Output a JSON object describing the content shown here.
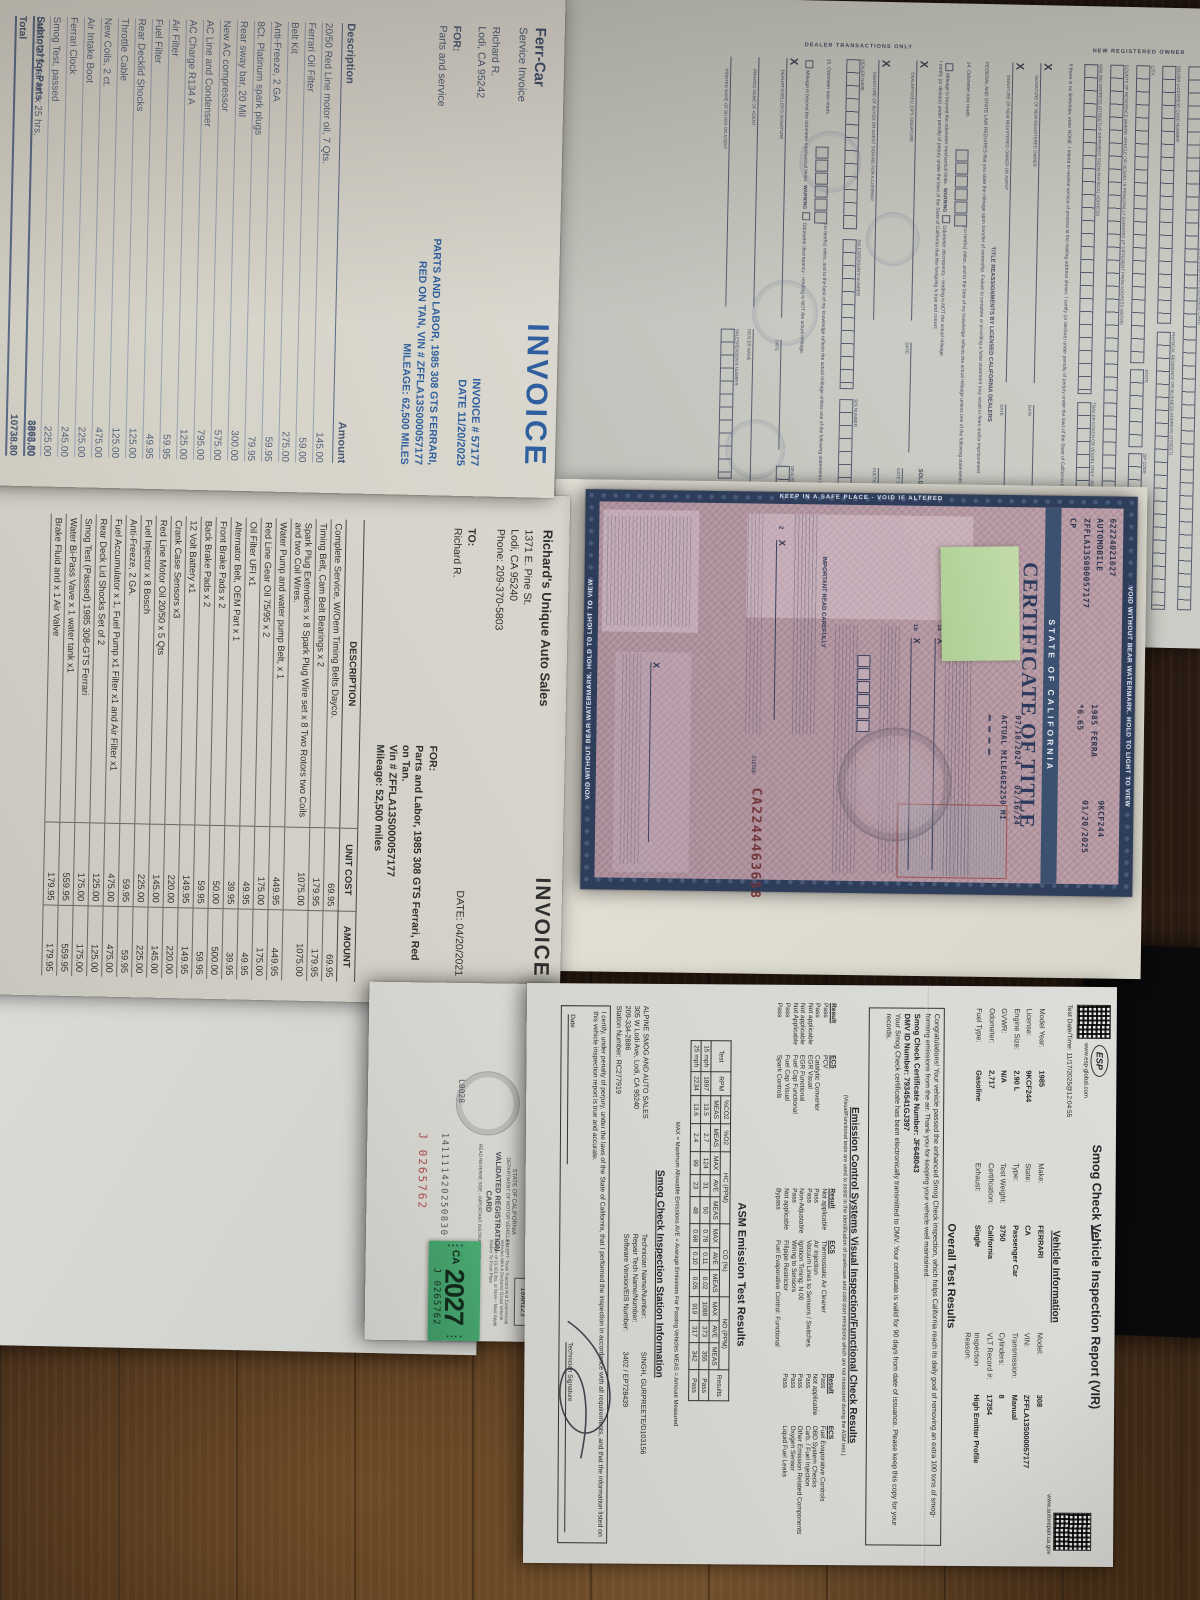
{
  "invoice1": {
    "company": "Ferr-Car",
    "subtitle": "Service Invoice",
    "customer_name": "Richard R.",
    "customer_city": "Lodi, CA 95242",
    "for_label": "FOR:",
    "for_value": "Parts and service",
    "title": "INVOICE",
    "invoice_no": "INVOICE # 57177",
    "date": "DATE 11/20/2025",
    "vehicle_line1": "PARTS AND LABOR, 1985 308 GTS FERRARI,",
    "vehicle_line2": "RED ON TAN, VIN # ZFFLA13S000057177",
    "vehicle_line3": "MILEAGE: 62,500 MILES",
    "col_desc": "Description",
    "col_amount": "Amount",
    "items": [
      {
        "d": "20/50 Red Line motor oil, 7 Qts.",
        "a": "145.00"
      },
      {
        "d": "Ferrari Oil Filter",
        "a": "59.00"
      },
      {
        "d": "Belt Kit",
        "a": "275.00"
      },
      {
        "d": "Anti-Freeze, 2 GA",
        "a": "59.95"
      },
      {
        "d": "8Ct. Platinum spark plugs",
        "a": "79.95"
      },
      {
        "d": "Rear sway bar, 20 Mil",
        "a": "300.00"
      },
      {
        "d": "New AC compressor",
        "a": "575.00"
      },
      {
        "d": "AC Line and Condenser",
        "a": "795.00"
      },
      {
        "d": "AC Charge R134 A",
        "a": "125.00"
      },
      {
        "d": "Air Filter",
        "a": "59.95"
      },
      {
        "d": "Fuel Filter",
        "a": "49.95"
      },
      {
        "d": "Rear Decklid Shocks",
        "a": "125.00"
      },
      {
        "d": "Throttle Cable",
        "a": "125.00"
      },
      {
        "d": "New Coils, 2 ct.",
        "a": "475.00"
      },
      {
        "d": "Air Intake Boot",
        "a": "225.00"
      },
      {
        "d": "Ferrari Clock",
        "a": "245.00"
      },
      {
        "d": "Smog Test, passed",
        "a": "225.00"
      },
      {
        "d": "Labor, 275 per hr. x 25 hrs.",
        "a": "6875.00"
      }
    ],
    "subtotal_label": "Subtotal for Parts",
    "subtotal": "3863.80",
    "total_label": "Total",
    "total": "10738.80"
  },
  "dmv_form": {
    "headline": "Any change of registered owner or lienholder must be recorded with the Department of Motor Vehicles (DMV) within ten (10) days. This transfer form, the title, and all smog and use-tax certificates must be presented to DMV to record the ownership change.",
    "section_owner": "NEW REGISTERED OWNER",
    "section_dealer": "DEALER TRANSACTIONS ONLY",
    "r1": "1a. TRUE FULL NAME OF NEW REGISTERED OWNER (LAST, FIRST, MIDDLE) AS IT APPEARS ON DRIVER LICENSE/ID CARD",
    "r2": "DRIVER LICENSE/ID CARD NUMBER",
    "r3": "PHYSICAL RESIDENCE OR BUSINESS ADDRESS (STREET)",
    "r4": "CITY",
    "r5": "STATE",
    "r6": "ZIP CODE",
    "r7": "COUNTY OF RESIDENCE WHERE VEHICLE OR VESSEL IS PRINCIPALLY GARAGED (IF DIFFERENT FROM ADDRESS ABOVE)",
    "r8": "MAILING ADDRESS (STREET) IF DIFFERENT FROM PHYSICAL ADDRESS",
    "r9": "TRAILER COACH OR VESSEL ONLY - ADDRESS WHERE LOCATED",
    "lien_text": "If there is no lienholder, enter NONE. I intend to receive service of process at the mailing address shown. I certify (or declare) under penalty of perjury under the laws of the State of California that the foregoing is true and correct.",
    "x": "X",
    "date_label": "DATE",
    "sig_owner": "SIGNATURE OF NEW REGISTERED OWNER",
    "sig_owner2": "SIGNATURE OF NEW REGISTERED OWNER OR AGENT",
    "reassign_title": "TITLE REASSIGNMENTS BY LICENSED CALIFORNIA DEALERS",
    "federal": "FEDERAL AND STATE LAW REQUIRES that you state the mileage upon transfer of ownership. Failure to complete or providing a false statement may result in fines and/or imprisonment.",
    "odo14": "14. Odometer now reads",
    "odo15": "15. Odometer now reads",
    "odo_tail": "(no tenths) miles, and to the best of my knowledge reflects the actual mileage unless one of the following statements is checked:",
    "warning": "WARNING",
    "opt1": "Mileage is beyond the odometer mechanical limits.",
    "opt2": "Odometer discrepancy - reading is NOT the actual mileage.",
    "certify": "I certify (or declare) under penalty of perjury under the laws of the State of California that the foregoing is true and correct.",
    "seller_sig": "DEALER'S/SELLER'S SIGNATURE",
    "buyer_sig": "SIGNATURE OF BUYER OR AGENT SIGNING FOR A COMPANY",
    "auction_title": "SOLD THROUGH AUCTION IF APPLICABLE",
    "auction_date": "DATE OF AUCTION",
    "auction_name": "AUCTION NAME",
    "printed_agent": "PRINTED NAME OF AGENT",
    "printed_buyer": "PRINTED NAME OF BUYER OR AGENT",
    "dealer_name": "DEALER NAME",
    "sales_no": "SALESPERSON'S NUMBER",
    "rs_no": "R/S NUMBER",
    "dealer_no": "DEALER NUMBER",
    "elt": "ELT #"
  },
  "title_doc": {
    "border_top": "VOID WITHOUT BEAR WATERMARK. HOLD TO LIGHT TO VIEW",
    "border_bottom": "VOID WITHOUT BEAR WATERMARK. HOLD TO LIGHT TO VIEW",
    "border_left": "KEEP IN A SAFE PLACE - VOID IF ALTERED",
    "state": "STATE OF CALIFORNIA",
    "title": "CERTIFICATE OF TITLE",
    "doc_no": "62224021627",
    "body_type": "AUTOMOBILE",
    "vin": "ZFFLA13S000057177",
    "code": "CP",
    "yr_make": "1985 FERRA",
    "fee": "*6.65",
    "license": "9KCF244",
    "expires": "01/20/2025",
    "issued": "07/18/2024",
    "odo_date": "02/16/24",
    "odometer": "2250 MI",
    "mileage_label": "ACTUAL MILEAGE",
    "important": "IMPORTANT READ CAREFULLY",
    "sig1": "1a",
    "sig1b": "1b",
    "sig2": "2",
    "x": "X",
    "control_no": "CA2244463658",
    "form_no": "016586"
  },
  "invoice2": {
    "company": "Richard's Unique Auto Sales",
    "addr1": "1371 E. Pine St.",
    "addr2": "Lodi, CA 95240",
    "addr3": "Phone: 209-370-5803",
    "to_label": "TO:",
    "to_value": "Richard R.",
    "title": "INVOICE",
    "date": "DATE: 04/20/2021",
    "for_label": "FOR:",
    "for1": "Parts and Labor, 1985 308 GTS Ferrari, Red",
    "for2": "on Tan.",
    "for3": "Vin # ZFFLA13S000057177",
    "for4": "Mileage: 52,500 miles",
    "col_desc": "DESCRIPTION",
    "col_unit": "UNIT COST",
    "col_amount": "AMOUNT",
    "items": [
      {
        "d": "Complete Service, W/Oem Timing Belts Dayco.",
        "u": "69.95",
        "a": "69.95"
      },
      {
        "d": "Timing Belt, Cam Belt Bearings x 2",
        "u": "179.95",
        "a": "179.95"
      },
      {
        "d": "Spark Plug Extenders x 8 Spark Plug Wire set x 8 Two Rotors two Coils and two Coil Wires.",
        "u": "1075.00",
        "a": "1075.00"
      },
      {
        "d": "Water Pump and water pump Belt, x 1",
        "u": "449.95",
        "a": "449.95"
      },
      {
        "d": "Red Line Gear Oil 75/95 x 2",
        "u": "175.00",
        "a": "175.00"
      },
      {
        "d": "Oil Filter UFI x1",
        "u": "49.95",
        "a": "49.95"
      },
      {
        "d": "Alternator Belt, OEM Part x 1",
        "u": "39.95",
        "a": "39.95"
      },
      {
        "d": "Front Brake Pads x 2",
        "u": "50.00",
        "a": "500.00"
      },
      {
        "d": "Back Brake Pads x 2",
        "u": "59.95",
        "a": "59.95"
      },
      {
        "d": "12 Volt Battery x1",
        "u": "149.95",
        "a": "149.95"
      },
      {
        "d": "Crank Case Sensors x3",
        "u": "220.00",
        "a": "220.00"
      },
      {
        "d": "Red Line Motor Oil 20/50 x 5 Qts",
        "u": "145.00",
        "a": "145.00"
      },
      {
        "d": "Fuel Injector x 8 Bosch",
        "u": "225.00",
        "a": "225.00"
      },
      {
        "d": "Anti-Freeze, 2 GA.",
        "u": "59.95",
        "a": "59.95"
      },
      {
        "d": "Fuel Accumulator x 1, Fuel Pump x1 Filter x1 and Air Filter x1",
        "u": "475.00",
        "a": "475.00"
      },
      {
        "d": "Rear Deck Lid Shocks Set of 2",
        "u": "125.00",
        "a": "125.00"
      },
      {
        "d": "Smog Test (Passed) 1985 308-GTS Ferrari",
        "u": "175.00",
        "a": "175.00"
      },
      {
        "d": "Water Bi-Pass Vave x 1 water tank x1",
        "u": "559.95",
        "a": "559.95"
      },
      {
        "d": "Brake Fluid and x 1 Air Valve",
        "u": "179.95",
        "a": "179.95"
      }
    ]
  },
  "reg_card": {
    "address_line": "LODI  CA  95242-8553",
    "state": "STATE OF CALIFORNIA",
    "dept": "DEPARTMENT OF MOTOR VEHICLES",
    "card_title": "VALIDATED REGISTRATION CARD",
    "note": "READ REVERSE SIDE - IMPORTANT INSTRUCTIONS",
    "number": "141111420250830",
    "code": "L0028",
    "serial": "J 0265762",
    "others_label": "All Others: In Top Right Corner",
    "plate": "18AM123",
    "except_text": "EXCEPT: Truck Tractors And Commercial Vehicles With A Declared Gross Vehicle Weight of 10,001 lbs. or More - Must Apply Sticker To Front Plate",
    "sticker_ca": "CA",
    "sticker_year": "2027",
    "sticker_serial": "J 0265762"
  },
  "smog": {
    "title": "Smog Check Vehicle Inspection Report (VIR)",
    "esp": "ESP",
    "esp_url": "www.esp-global.com",
    "test_dt": "Test Date/Time: 11/17/2025@12:04:55",
    "ca_url": "www.autorepair.ca.gov",
    "veh_header": "Vehicle Information",
    "veh_fields": [
      {
        "k": "Model Year:",
        "v": "1985"
      },
      {
        "k": "Make:",
        "v": "FERRARI"
      },
      {
        "k": "Model:",
        "v": "308"
      },
      {
        "k": "License:",
        "v": "9KCF244"
      },
      {
        "k": "State:",
        "v": "CA"
      },
      {
        "k": "VIN:",
        "v": "ZFFLA13S000057177"
      },
      {
        "k": "Engine Size:",
        "v": "2.90 L"
      },
      {
        "k": "Type:",
        "v": "Passenger Car"
      },
      {
        "k": "Transmission:",
        "v": "Manual"
      },
      {
        "k": "GVWR:",
        "v": "N/A"
      },
      {
        "k": "Test Weight:",
        "v": "3750"
      },
      {
        "k": "Cylinders:",
        "v": "8"
      },
      {
        "k": "Odometer:",
        "v": "2,717"
      },
      {
        "k": "Certification:",
        "v": "California"
      },
      {
        "k": "VLT Record #:",
        "v": "17354"
      },
      {
        "k": "Fuel Type:",
        "v": "Gasoline"
      },
      {
        "k": "Exhaust:",
        "v": "Single"
      },
      {
        "k": "Inspection Reason:",
        "v": "High Emitter Profile"
      }
    ],
    "overall_header": "Overall Test Results",
    "congrats": "Congratulations! Your vehicle passed the enhanced Smog Check inspection, which helps California reach its daily goal of removing an extra 100 tons of smog-forming emissions from the air. Thank you for keeping your vehicle well maintained.",
    "cert_no": "Smog Check Certificate Number: JF648043",
    "dmv_id": "DMV ID Number: 7934541GJ397",
    "note1": "Your Smog Check certificate has been electronically transmitted to DMV.",
    "note2": "Your certificate is valid for 90 days from date of issuance.",
    "note3": "Please keep this copy for your records.",
    "ecs_header": "Emission Control Systems Visual Inspection/Functional Check Results",
    "ecs_sub": "(Visual/Functional tests are used to assist in the identification of crankcase and cold start emissions which are not measured during the ASM test.)",
    "col_result": "Result",
    "col_ecs": "ECS",
    "ecs1": [
      {
        "r": "Pass",
        "e": "PCV"
      },
      {
        "r": "Pass",
        "e": "Catalytic Converter"
      },
      {
        "r": "Not applicable",
        "e": "EGR Visual"
      },
      {
        "r": "Not applicable",
        "e": "EGR Functional"
      },
      {
        "r": "Not Applicable",
        "e": "Fuel Cap Functional"
      },
      {
        "r": "Pass",
        "e": "Fuel Cap Visual"
      },
      {
        "r": "Pass",
        "e": "Spark Controls"
      }
    ],
    "ecs2": [
      {
        "r": "Not applicable",
        "e": "Thermostatic Air Cleaner"
      },
      {
        "r": "Pass",
        "e": "Air Injection"
      },
      {
        "r": "Pass",
        "e": "Vacuum Lines to Sensors / Switches"
      },
      {
        "r": "Non-Adjustable",
        "e": "Ignition Timing: N 00"
      },
      {
        "r": "Pass",
        "e": "Wiring to Sensors"
      },
      {
        "r": "Not applicable",
        "e": "Fillpipe Restrictor"
      },
      {
        "r": "Bypass",
        "e": "Fuel Evaporative Control: Functional"
      }
    ],
    "ecs3": [
      {
        "r": "Pass",
        "e": "Fuel Evaporative Controls"
      },
      {
        "r": "Not applicable",
        "e": "OBD System Checks"
      },
      {
        "r": "Pass",
        "e": "Carb. / Fuel Injection"
      },
      {
        "r": "Pass",
        "e": "Other Emission Related Components"
      },
      {
        "r": "Pass",
        "e": "Oxygen Sensor"
      },
      {
        "r": "Pass",
        "e": "Liquid Fuel Leaks"
      }
    ],
    "asm_header": "ASM Emission Test Results",
    "asm_h": {
      "test": "Test",
      "rpm": "RPM",
      "co2": "%CO2",
      "o2": "%O2",
      "hc": "HC (PPM)",
      "co": "CO (%)",
      "no": "NO (PPM)",
      "res": "Results",
      "meas": "MEAS",
      "max": "MAX",
      "ave": "AVE"
    },
    "asm_rows": [
      {
        "test": "15 mph",
        "rpm": "1897",
        "co2": "13.5",
        "o2": "2.7",
        "hcmax": "124",
        "hcave": "31",
        "hcmeas": "50",
        "comax": "0.78",
        "coave": "0.11",
        "comeas": "0.02",
        "nomax": "1088",
        "noave": "373",
        "nomeas": "355",
        "res": "Pass"
      },
      {
        "test": "25 mph",
        "rpm": "2234",
        "co2": "13.6",
        "o2": "2.4",
        "hcmax": "99",
        "hcave": "23",
        "hcmeas": "48",
        "comax": "0.68",
        "coave": "0.10",
        "comeas": "0.05",
        "nomax": "919",
        "noave": "317",
        "nomeas": "342",
        "res": "Pass"
      }
    ],
    "legend": "MAX = Maximum Allowable Emissions      AVE = Average Emissions For Passing Vehicles      MEAS = Amount Measured",
    "station_header": "Smog Check Inspection Station Information",
    "station_lines": [
      "ALPINE SMOG AND AUTO SALES",
      "305 W Lodi Ave, Lodi, CA 95240",
      "209-334-2886",
      "Station Number: RC277919"
    ],
    "tech_rows": [
      {
        "k": "Technician Name/Number:",
        "v": "SINGH, GURPREETE/D103156"
      },
      {
        "k": "Repair Tech Name/Number:",
        "v": ""
      },
      {
        "k": "Software Version/EIS Number:",
        "v": "3402 / EP728439"
      }
    ],
    "certify": "I certify, under penalty of perjury, under the laws of the State of California, that I performed the inspection in accordance with all requirements, and that the information listed on this vehicle inspection report is true and accurate.",
    "date_label": "Date",
    "sig_label": "Technician Signature"
  }
}
